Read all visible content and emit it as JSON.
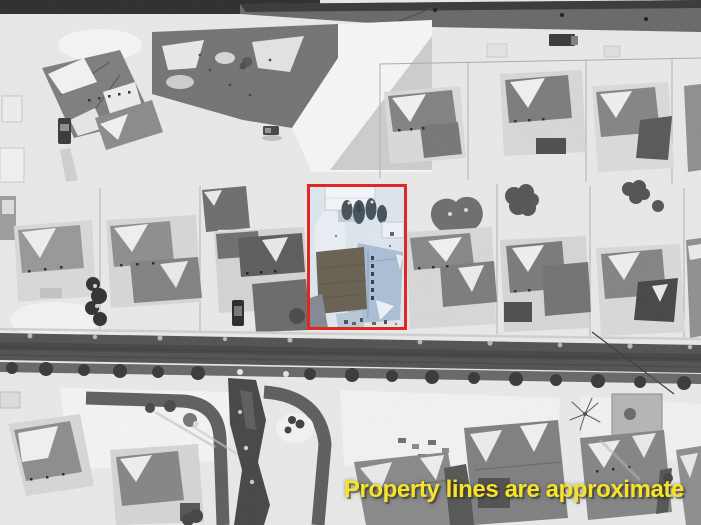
{
  "image": {
    "kind": "aerial-drone-photo",
    "description": "Black-and-white winter aerial view of a snowy suburban neighborhood; one lot outlined in red and shown in color",
    "season": "winter-snow"
  },
  "annotation": {
    "text": "Property lines are approximate"
  },
  "highlight": {
    "label": "highlighted-property-lot"
  },
  "palette": {
    "boundary_red": "#e2231d",
    "annotation_yellow": "#f7e329",
    "snow_base": "#e8e8e8",
    "road_gray": "#535353",
    "top_road_gray": "#696969",
    "treeline_dark": "#3a3a3a",
    "lot_snow_blue": "#dde5ed",
    "lot_roof_blue": "#a9bfd4",
    "lot_roof_dark": "#696253",
    "lot_evergreen": "#46525a"
  }
}
